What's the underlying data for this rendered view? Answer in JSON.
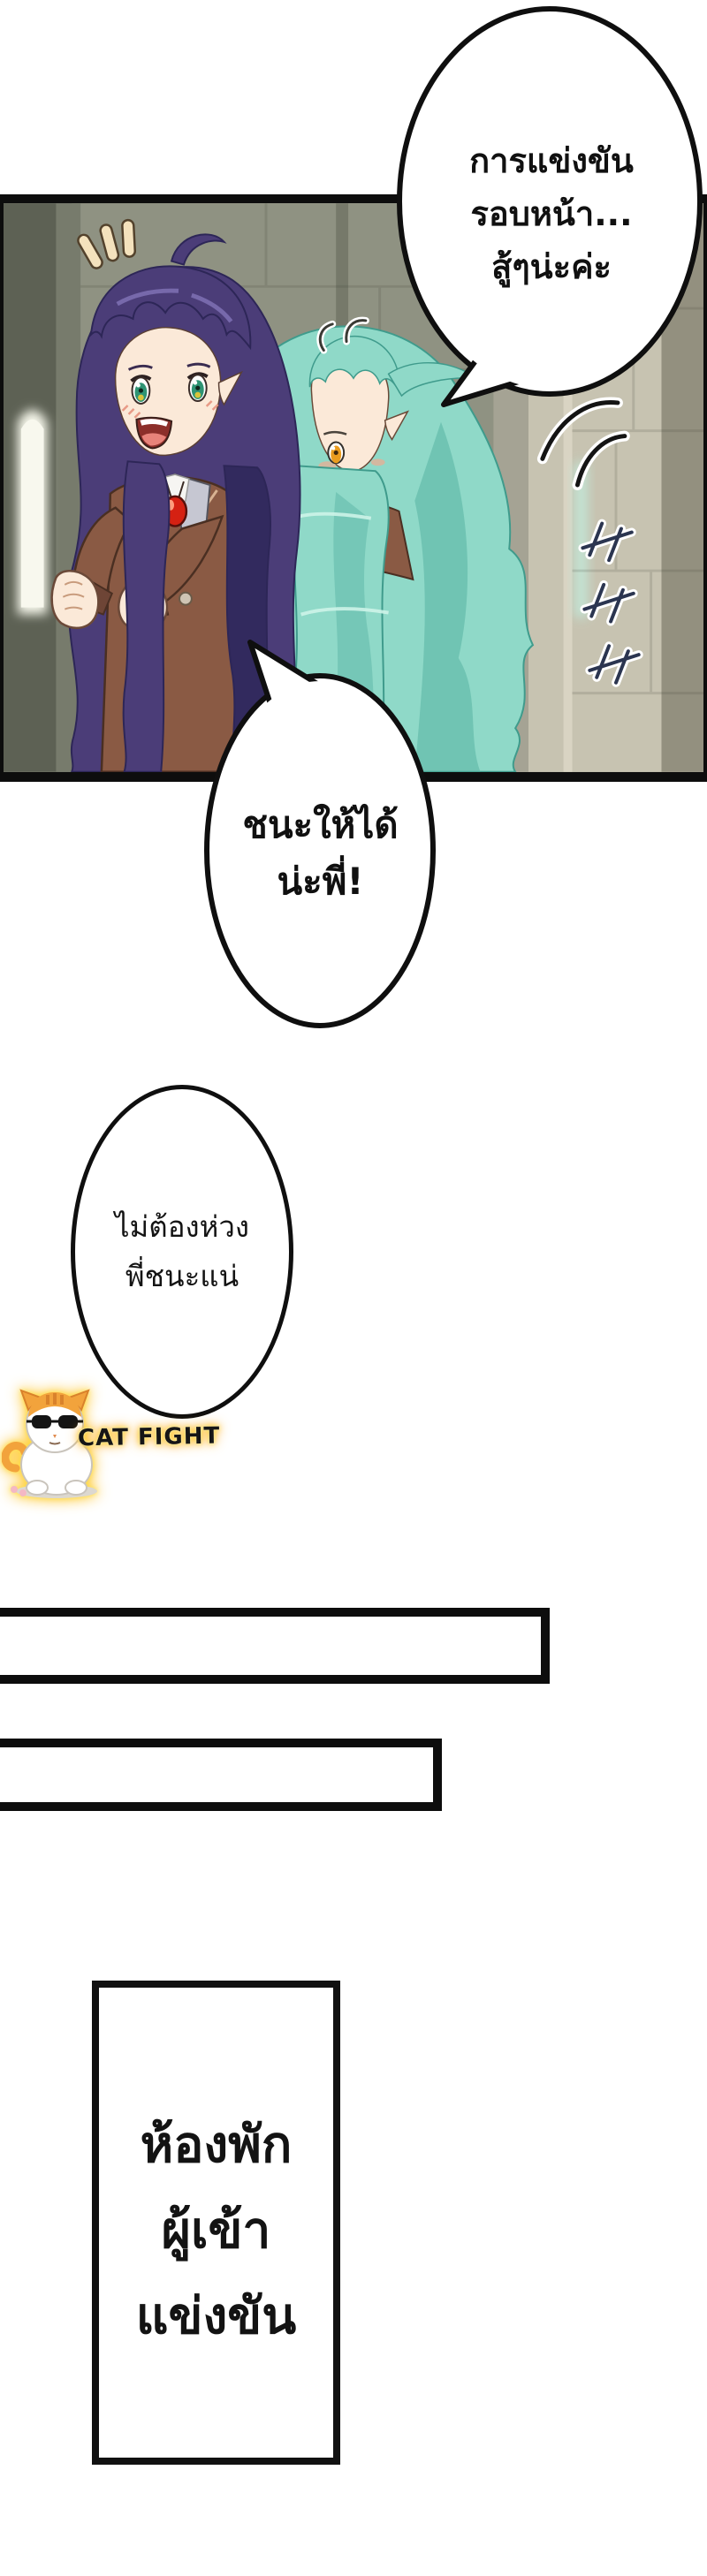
{
  "bubbles": {
    "b1": {
      "lines": [
        "การแข่งขัน",
        "รอบหน้า...",
        "สู้ๆน่ะค่ะ"
      ]
    },
    "b2": {
      "lines": [
        "ชนะให้ได้",
        "น่ะพี่!"
      ]
    },
    "b3": {
      "lines": [
        "ไม่ต้องห่วง",
        "พี่ชนะแน่"
      ]
    }
  },
  "sign": {
    "lines": [
      "ห้องพัก",
      "ผู้เข้า",
      "แข่งขัน"
    ]
  },
  "watermark": {
    "label": "CAT FIGHT",
    "icon": "sunglasses-cat-icon",
    "glow_color": "#ffc21e"
  },
  "colors": {
    "page_bg": "#ffffff",
    "ink": "#111111",
    "stone_base": "#8f9282",
    "stone_dark": "#5d6154",
    "stone_light": "#c7c3b1",
    "window_glow": "#f5f6ea",
    "light_slit": "#c2e9da",
    "hair_purple": "#4b3d78",
    "hair_purple_dark": "#322a5e",
    "hair_purple_line": "#2d2657",
    "hair_teal": "#8fd9c8",
    "hair_teal_dark": "#57b2a2",
    "hair_teal_line": "#3f9b8c",
    "skin": "#fbe9d8",
    "blush": "#f0a98e",
    "blazer": "#8a5a44",
    "blazer_dark": "#6e4536",
    "blazer_line": "#4a2f22",
    "lapel_grey": "#c6c7d2",
    "shirt_white": "#f6f5f2",
    "gem_red": "#d52112",
    "eye_green": "#2f9474",
    "eye_amber": "#eb9c1e",
    "cat_orange": "#f2a33c",
    "glow_yellow": "#ffc21e"
  }
}
